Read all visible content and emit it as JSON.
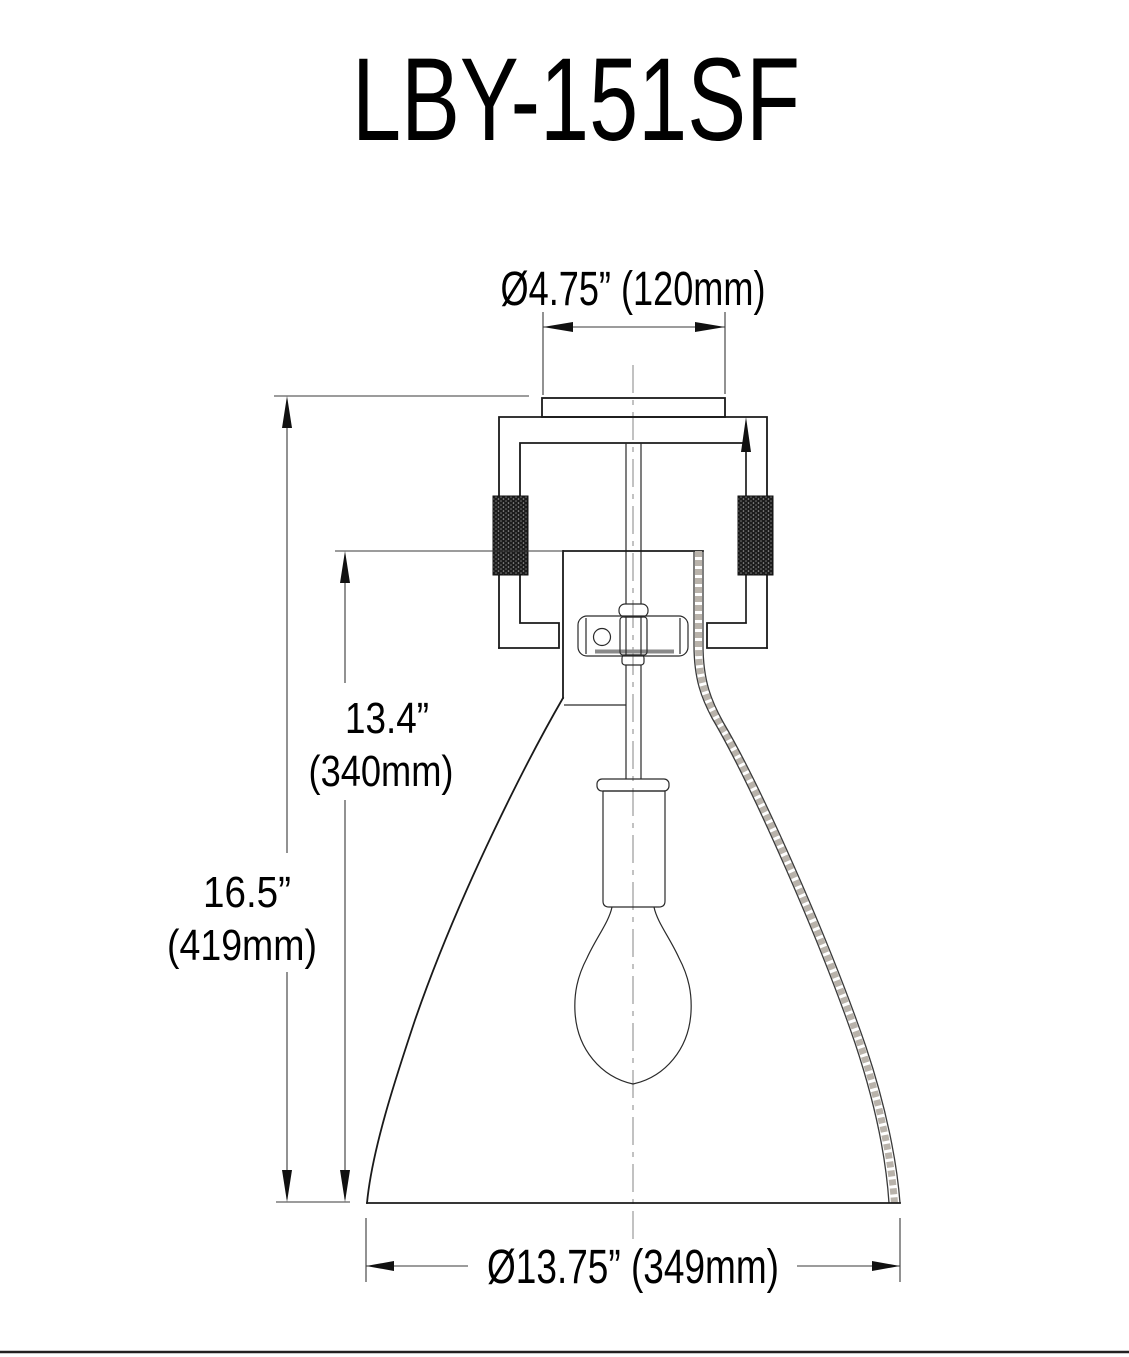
{
  "title": "LBY-151SF",
  "drawing_type_labels": {
    "description": "flush-mount-light-fixture-dimension-drawing"
  },
  "dimensions": {
    "canopy_diameter": "Ø4.75” (120mm)",
    "shade_height": {
      "line1": "13.4”",
      "line2": "(340mm)"
    },
    "overall_height": {
      "line1": "16.5”",
      "line2": "(419mm)"
    },
    "shade_diameter": "Ø13.75” (349mm)"
  },
  "colors": {
    "background": "#ffffff",
    "object_line": "#1a1a1a",
    "dimension_line": "#3a3a3a",
    "centerline": "#999999",
    "text": "#000000"
  }
}
